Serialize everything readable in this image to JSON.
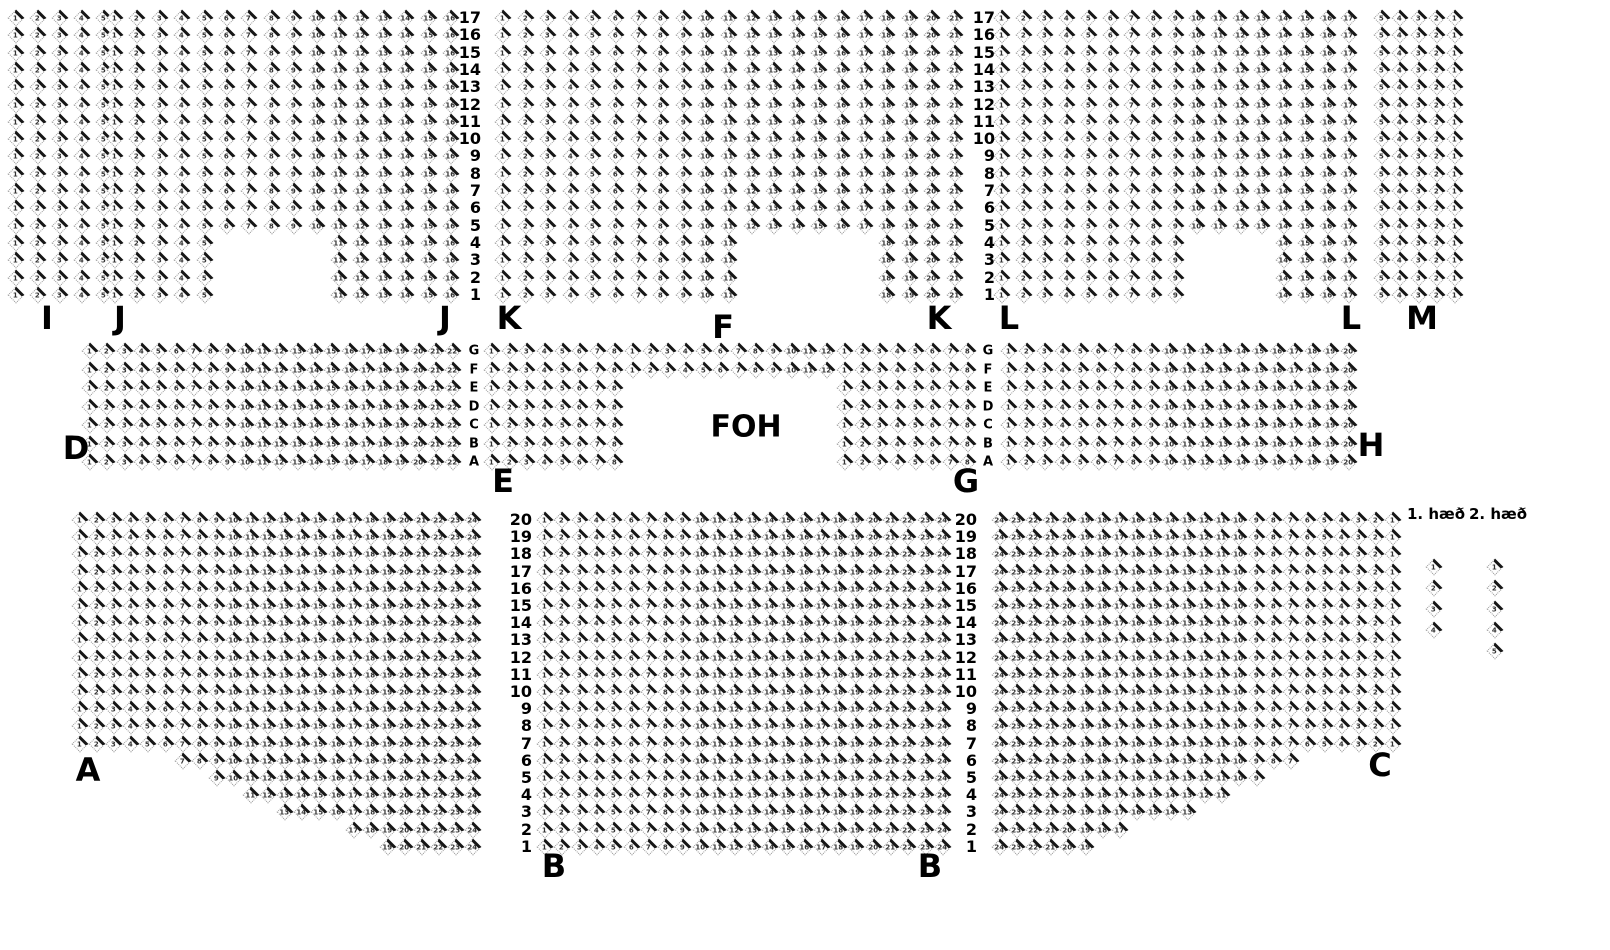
{
  "foh_label": "FOH",
  "colors": {
    "background": "#ffffff",
    "seat_outline": "#999999",
    "seat_accent": "#161616",
    "seat_number": "#333333",
    "text": "#000000"
  },
  "legend": {
    "floor1_label": "1. hæð",
    "floor2_label": "2. hæð",
    "columns": [
      {
        "name": "floor1-categories",
        "x": 1434,
        "y": 567,
        "dy": 21,
        "digits": [
          "1",
          "2",
          "3",
          "4"
        ]
      },
      {
        "name": "floor2-categories",
        "x": 1495,
        "y": 567,
        "dy": 21,
        "digits": [
          "1",
          "2",
          "3",
          "4",
          "5"
        ]
      }
    ]
  },
  "section_labels": [
    {
      "t": "I",
      "x": 47,
      "y": 318
    },
    {
      "t": "J",
      "x": 120,
      "y": 318
    },
    {
      "t": "J",
      "x": 445,
      "y": 318
    },
    {
      "t": "K",
      "x": 509,
      "y": 318
    },
    {
      "t": "K",
      "x": 939,
      "y": 318
    },
    {
      "t": "F",
      "x": 723,
      "y": 327
    },
    {
      "t": "L",
      "x": 1009,
      "y": 318
    },
    {
      "t": "L",
      "x": 1351,
      "y": 318
    },
    {
      "t": "M",
      "x": 1422,
      "y": 318
    },
    {
      "t": "D",
      "x": 76,
      "y": 448
    },
    {
      "t": "E",
      "x": 503,
      "y": 481
    },
    {
      "t": "G",
      "x": 966,
      "y": 481
    },
    {
      "t": "H",
      "x": 1371,
      "y": 445
    },
    {
      "t": "A",
      "x": 88,
      "y": 770
    },
    {
      "t": "B",
      "x": 554,
      "y": 866
    },
    {
      "t": "B",
      "x": 930,
      "y": 866
    },
    {
      "t": "C",
      "x": 1380,
      "y": 765
    }
  ],
  "axis_columns": [
    {
      "name": "row-numbers-jk",
      "x": 481,
      "y": 18,
      "dy": 17.3,
      "align": "right",
      "size": 16,
      "items": [
        "17",
        "16",
        "15",
        "14",
        "13",
        "12",
        "11",
        "10",
        "9",
        "8",
        "7",
        "6",
        "5",
        "4",
        "3",
        "2",
        "1"
      ]
    },
    {
      "name": "row-numbers-kl",
      "x": 995,
      "y": 18,
      "dy": 17.3,
      "align": "right",
      "size": 16,
      "items": [
        "17",
        "16",
        "15",
        "14",
        "13",
        "12",
        "11",
        "10",
        "9",
        "8",
        "7",
        "6",
        "5",
        "4",
        "3",
        "2",
        "1"
      ]
    },
    {
      "name": "row-letters-left",
      "x": 474,
      "y": 351,
      "dy": 18.5,
      "align": "center",
      "size": 13,
      "items": [
        "G",
        "F",
        "E",
        "D",
        "C",
        "B",
        "A"
      ]
    },
    {
      "name": "row-letters-right",
      "x": 988,
      "y": 351,
      "dy": 18.5,
      "align": "center",
      "size": 13,
      "items": [
        "G",
        "F",
        "E",
        "D",
        "C",
        "B",
        "A"
      ]
    },
    {
      "name": "row-numbers-ab",
      "x": 532,
      "y": 520,
      "dy": 17.2,
      "align": "right",
      "size": 16,
      "items": [
        "20",
        "19",
        "18",
        "17",
        "16",
        "15",
        "14",
        "13",
        "12",
        "11",
        "10",
        "9",
        "8",
        "7",
        "6",
        "5",
        "4",
        "3",
        "2",
        "1"
      ]
    },
    {
      "name": "row-numbers-bc",
      "x": 977,
      "y": 520,
      "dy": 17.2,
      "align": "right",
      "size": 16,
      "items": [
        "20",
        "19",
        "18",
        "17",
        "16",
        "15",
        "14",
        "13",
        "12",
        "11",
        "10",
        "9",
        "8",
        "7",
        "6",
        "5",
        "4",
        "3",
        "2",
        "1"
      ]
    }
  ],
  "seat_sections": [
    {
      "name": "I",
      "x": 16,
      "y": 18,
      "dx": 22.0,
      "dy": 17.3,
      "cols": 5,
      "rows": 17
    },
    {
      "name": "J",
      "x": 115,
      "y": 18,
      "dx": 22.4,
      "dy": 17.3,
      "cols": 16,
      "rows": 17,
      "notch": [
        13,
        16,
        5,
        9
      ]
    },
    {
      "name": "K",
      "x": 503,
      "y": 18,
      "dx": 22.6,
      "dy": 17.3,
      "cols": 21,
      "rows": 17,
      "notch": [
        13,
        16,
        11,
        16
      ]
    },
    {
      "name": "L",
      "x": 1002,
      "y": 18,
      "dx": 21.7,
      "dy": 17.3,
      "cols": 17,
      "rows": 17,
      "notch": [
        13,
        16,
        9,
        12
      ]
    },
    {
      "name": "M",
      "x": 1382,
      "y": 18,
      "dx": 18.3,
      "dy": 17.3,
      "cols": 5,
      "rows": 17,
      "dir": -1
    },
    {
      "name": "D",
      "x": 90,
      "y": 351,
      "dx": 17.3,
      "dy": 18.5,
      "cols": 22,
      "rows": 7
    },
    {
      "name": "E",
      "x": 492,
      "y": 351,
      "dx": 17.63,
      "dy": 18.5,
      "cols": 8,
      "rows": 7
    },
    {
      "name": "F",
      "x": 633,
      "y": 351,
      "dx": 17.63,
      "dy": 18.5,
      "cols": 12,
      "rows": 2
    },
    {
      "name": "G",
      "x": 845,
      "y": 351,
      "dx": 17.63,
      "dy": 18.5,
      "cols": 8,
      "rows": 7
    },
    {
      "name": "H",
      "x": 1009,
      "y": 351,
      "dx": 17.9,
      "dy": 18.5,
      "cols": 20,
      "rows": 7
    },
    {
      "name": "A",
      "x": 80,
      "y": 520,
      "dx": 17.1,
      "dy": 17.2,
      "cols": 24,
      "rows": 20,
      "left_cut": {
        "14": 6,
        "15": 8,
        "16": 10,
        "17": 12,
        "18": 16,
        "19": 18
      }
    },
    {
      "name": "B",
      "x": 545,
      "y": 520,
      "dx": 17.3,
      "dy": 17.2,
      "cols": 24,
      "rows": 20
    },
    {
      "name": "C",
      "x": 1000,
      "y": 520,
      "dx": 17.1,
      "dy": 17.2,
      "cols": 24,
      "rows": 20,
      "dir": -1,
      "right_cut": {
        "14": 6,
        "15": 8,
        "16": 10,
        "17": 12,
        "18": 16,
        "19": 18
      }
    }
  ]
}
